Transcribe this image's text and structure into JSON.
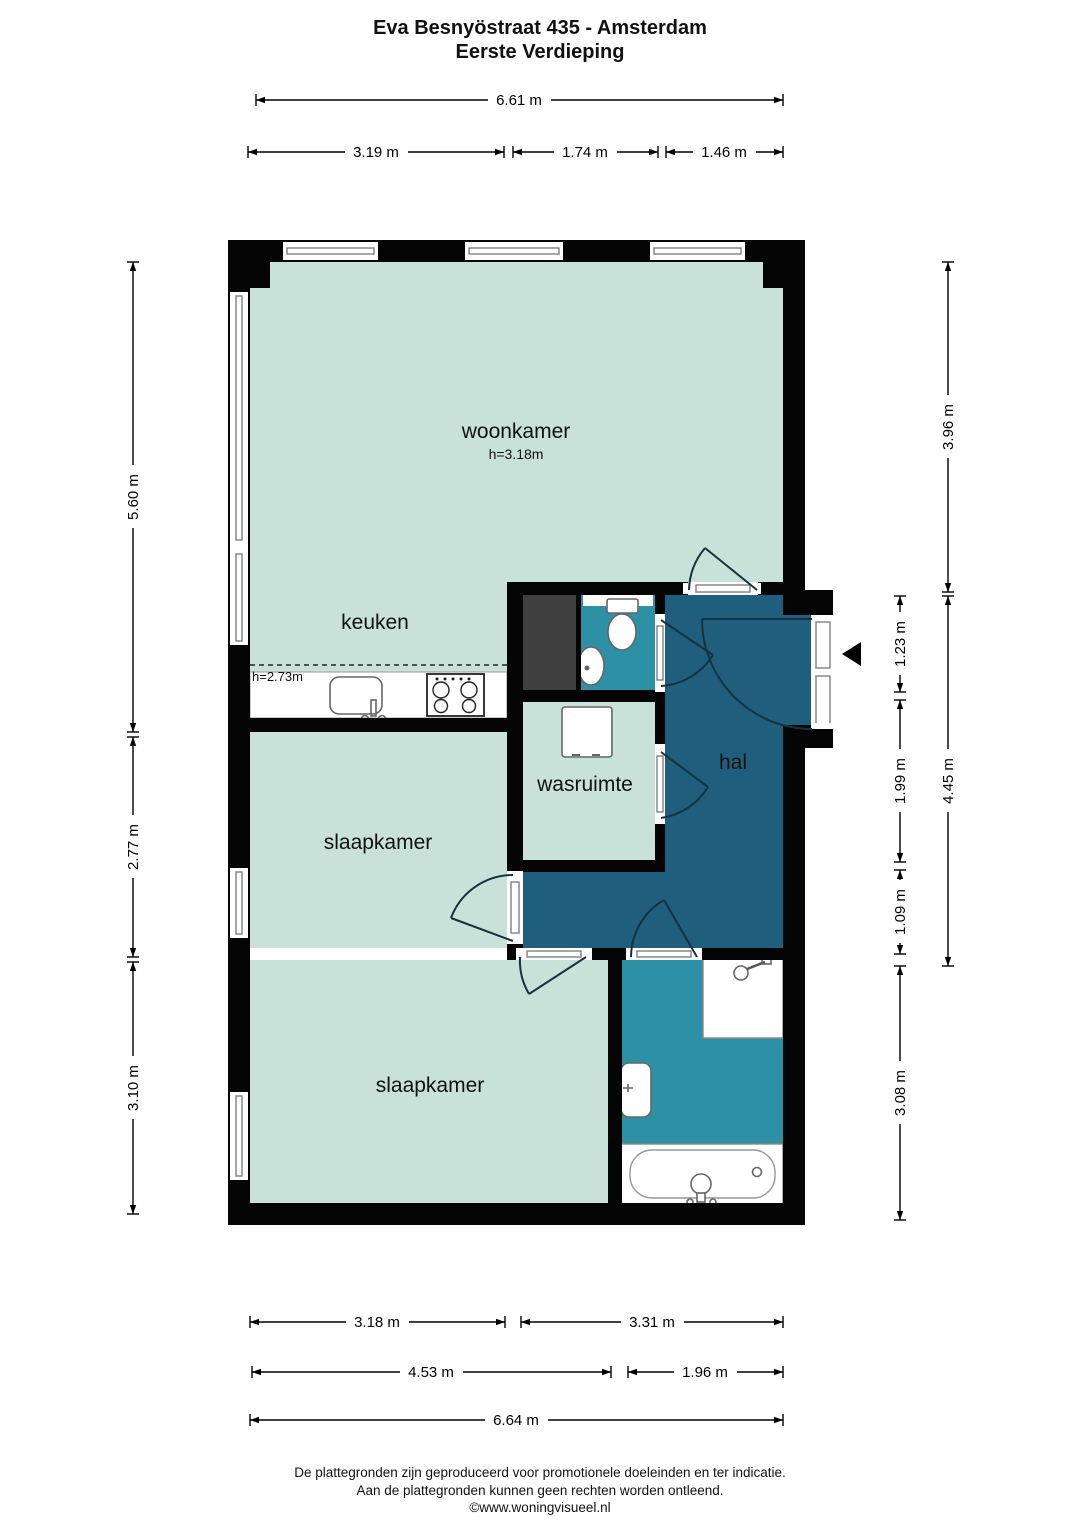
{
  "title": {
    "line1": "Eva Besnyöstraat 435 - Amsterdam",
    "line2": "Eerste Verdieping"
  },
  "rooms": {
    "woonkamer": {
      "label": "woonkamer",
      "height": "h=3.18m"
    },
    "keuken": {
      "label": "keuken",
      "height": "h=2.73m"
    },
    "wasruimte": {
      "label": "wasruimte"
    },
    "hal": {
      "label": "hal"
    },
    "slaapkamer1": {
      "label": "slaapkamer"
    },
    "slaapkamer2": {
      "label": "slaapkamer"
    }
  },
  "dims": {
    "top_total": "6.61 m",
    "top_1": "3.19 m",
    "top_2": "1.74 m",
    "top_3": "1.46 m",
    "left_1": "5.60 m",
    "left_2": "2.77 m",
    "left_3": "3.10 m",
    "right_outer_1": "3.96 m",
    "right_outer_2": "4.45 m",
    "right_inner_1": "1.23 m",
    "right_inner_2": "1.99 m",
    "right_inner_3": "1.09 m",
    "right_inner_4": "3.08 m",
    "bottom_1a": "3.18 m",
    "bottom_1b": "3.31 m",
    "bottom_2a": "4.53 m",
    "bottom_2b": "1.96 m",
    "bottom_total": "6.64 m"
  },
  "footer": {
    "line1": "De plattegronden zijn geproduceerd voor promotionele doeleinden en ter indicatie.",
    "line2": "Aan de plattegronden kunnen geen rechten worden ontleend.",
    "line3": "©www.woningvisueel.nl"
  },
  "fixtures": [
    "toilet",
    "toilet-basin",
    "closet",
    "washing-machine",
    "kitchen-sink",
    "stove",
    "shower",
    "washbasin",
    "bathtub",
    "entrance-arrow"
  ],
  "colors": {
    "room_fill": "#c9e2d9",
    "hal_fill": "#1f5f7d",
    "bath_fill": "#2e90a4",
    "closet_fill": "#3f3f3f",
    "wall": "#050505"
  }
}
